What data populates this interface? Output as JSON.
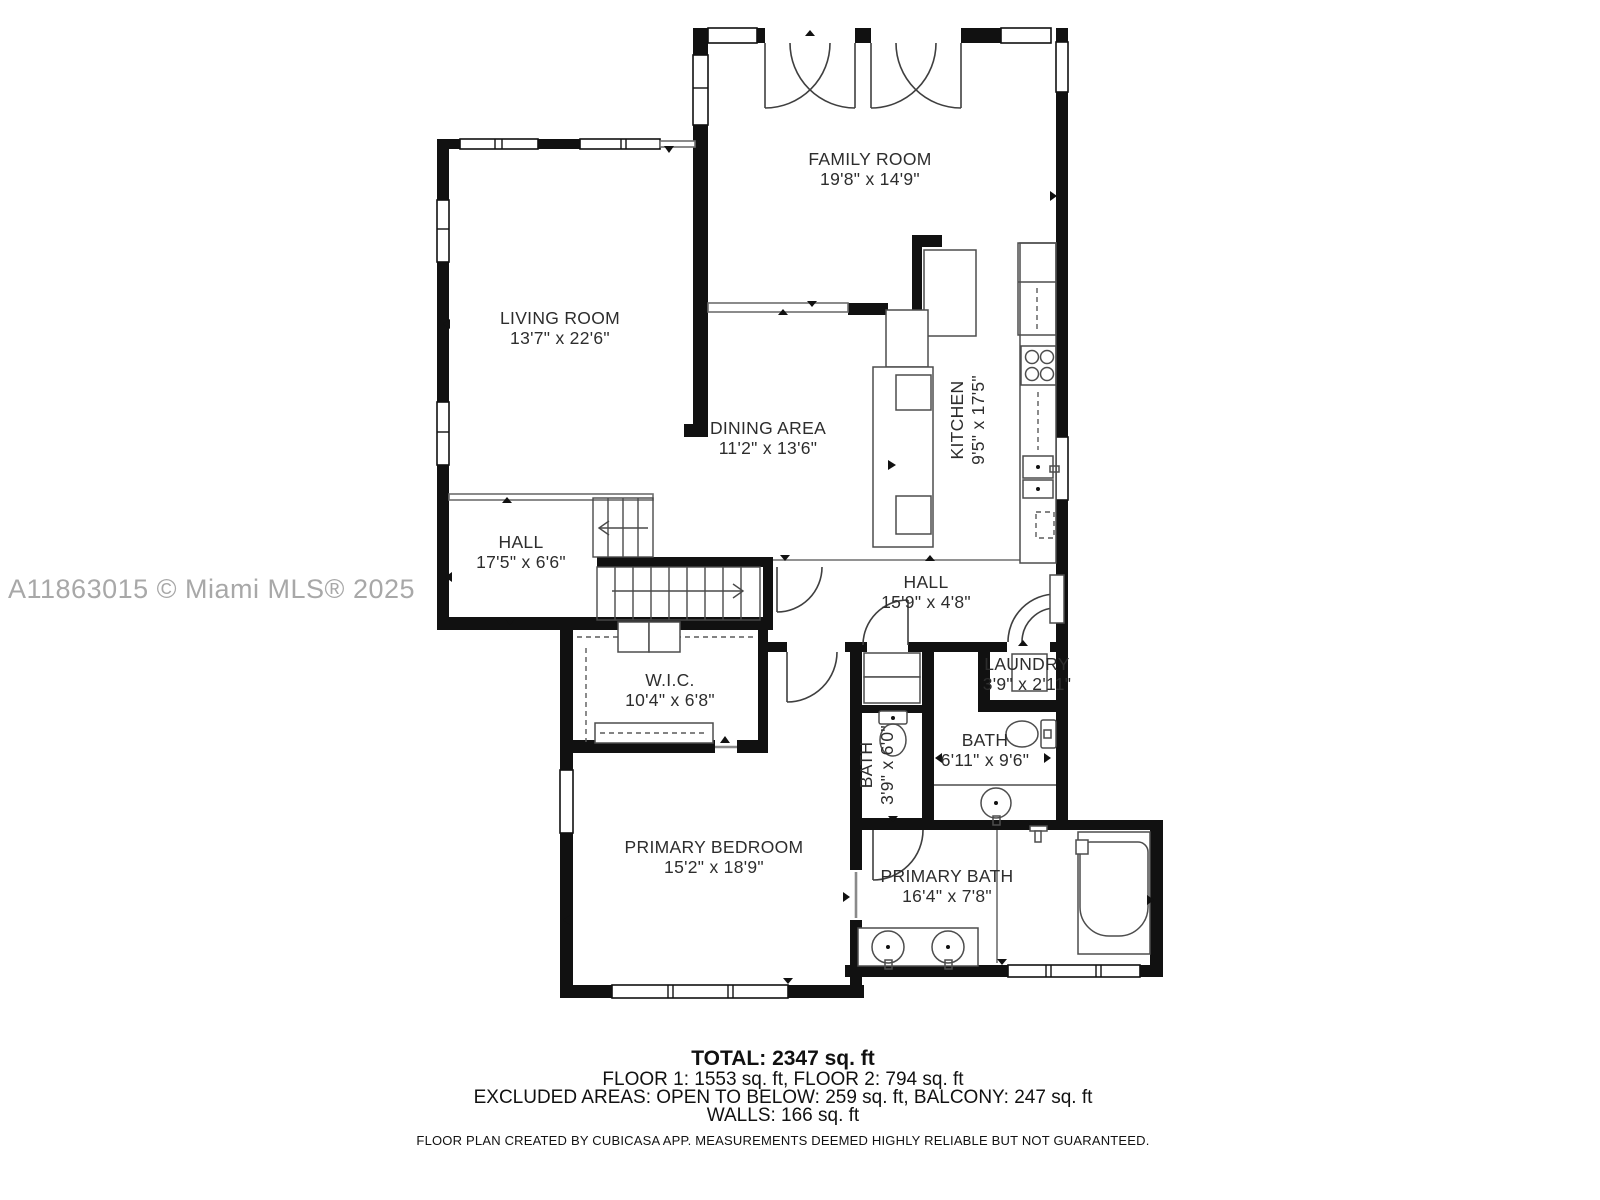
{
  "watermark": "A11863015 © Miami MLS® 2025",
  "rooms": {
    "family_room": {
      "name": "FAMILY ROOM",
      "dims": "19'8\" x 14'9\""
    },
    "living_room": {
      "name": "LIVING ROOM",
      "dims": "13'7\" x 22'6\""
    },
    "dining_area": {
      "name": "DINING AREA",
      "dims": "11'2\" x 13'6\""
    },
    "kitchen": {
      "name": "KITCHEN",
      "dims": "9'5\" x 17'5\""
    },
    "hall_1": {
      "name": "HALL",
      "dims": "17'5\" x 6'6\""
    },
    "hall_2": {
      "name": "HALL",
      "dims": "15'9\" x 4'8\""
    },
    "wic": {
      "name": "W.I.C.",
      "dims": "10'4\" x 6'8\""
    },
    "laundry": {
      "name": "LAUNDRY",
      "dims": "3'9\" x 2'11\""
    },
    "bath_small": {
      "name": "BATH",
      "dims": "3'9\" x 6'0\""
    },
    "bath": {
      "name": "BATH",
      "dims": "6'11\" x 9'6\""
    },
    "primary_bedroom": {
      "name": "PRIMARY BEDROOM",
      "dims": "15'2\" x 18'9\""
    },
    "primary_bath": {
      "name": "PRIMARY BATH",
      "dims": "16'4\" x 7'8\""
    }
  },
  "summary": {
    "total": "TOTAL: 2347 sq. ft",
    "floors": "FLOOR 1: 1553 sq. ft, FLOOR 2: 794 sq. ft",
    "excluded_areas": "EXCLUDED AREAS: OPEN TO BELOW: 259 sq. ft, BALCONY: 247 sq. ft",
    "walls": "WALLS: 166 sq. ft",
    "disclaimer": "FLOOR PLAN CREATED BY CUBICASA APP. MEASUREMENTS DEEMED HIGHLY RELIABLE BUT NOT GUARANTEED."
  },
  "colors": {
    "wall": "#111111",
    "label": "#2d2d2d",
    "watermark": "#a8a8a8",
    "background": "#ffffff"
  }
}
